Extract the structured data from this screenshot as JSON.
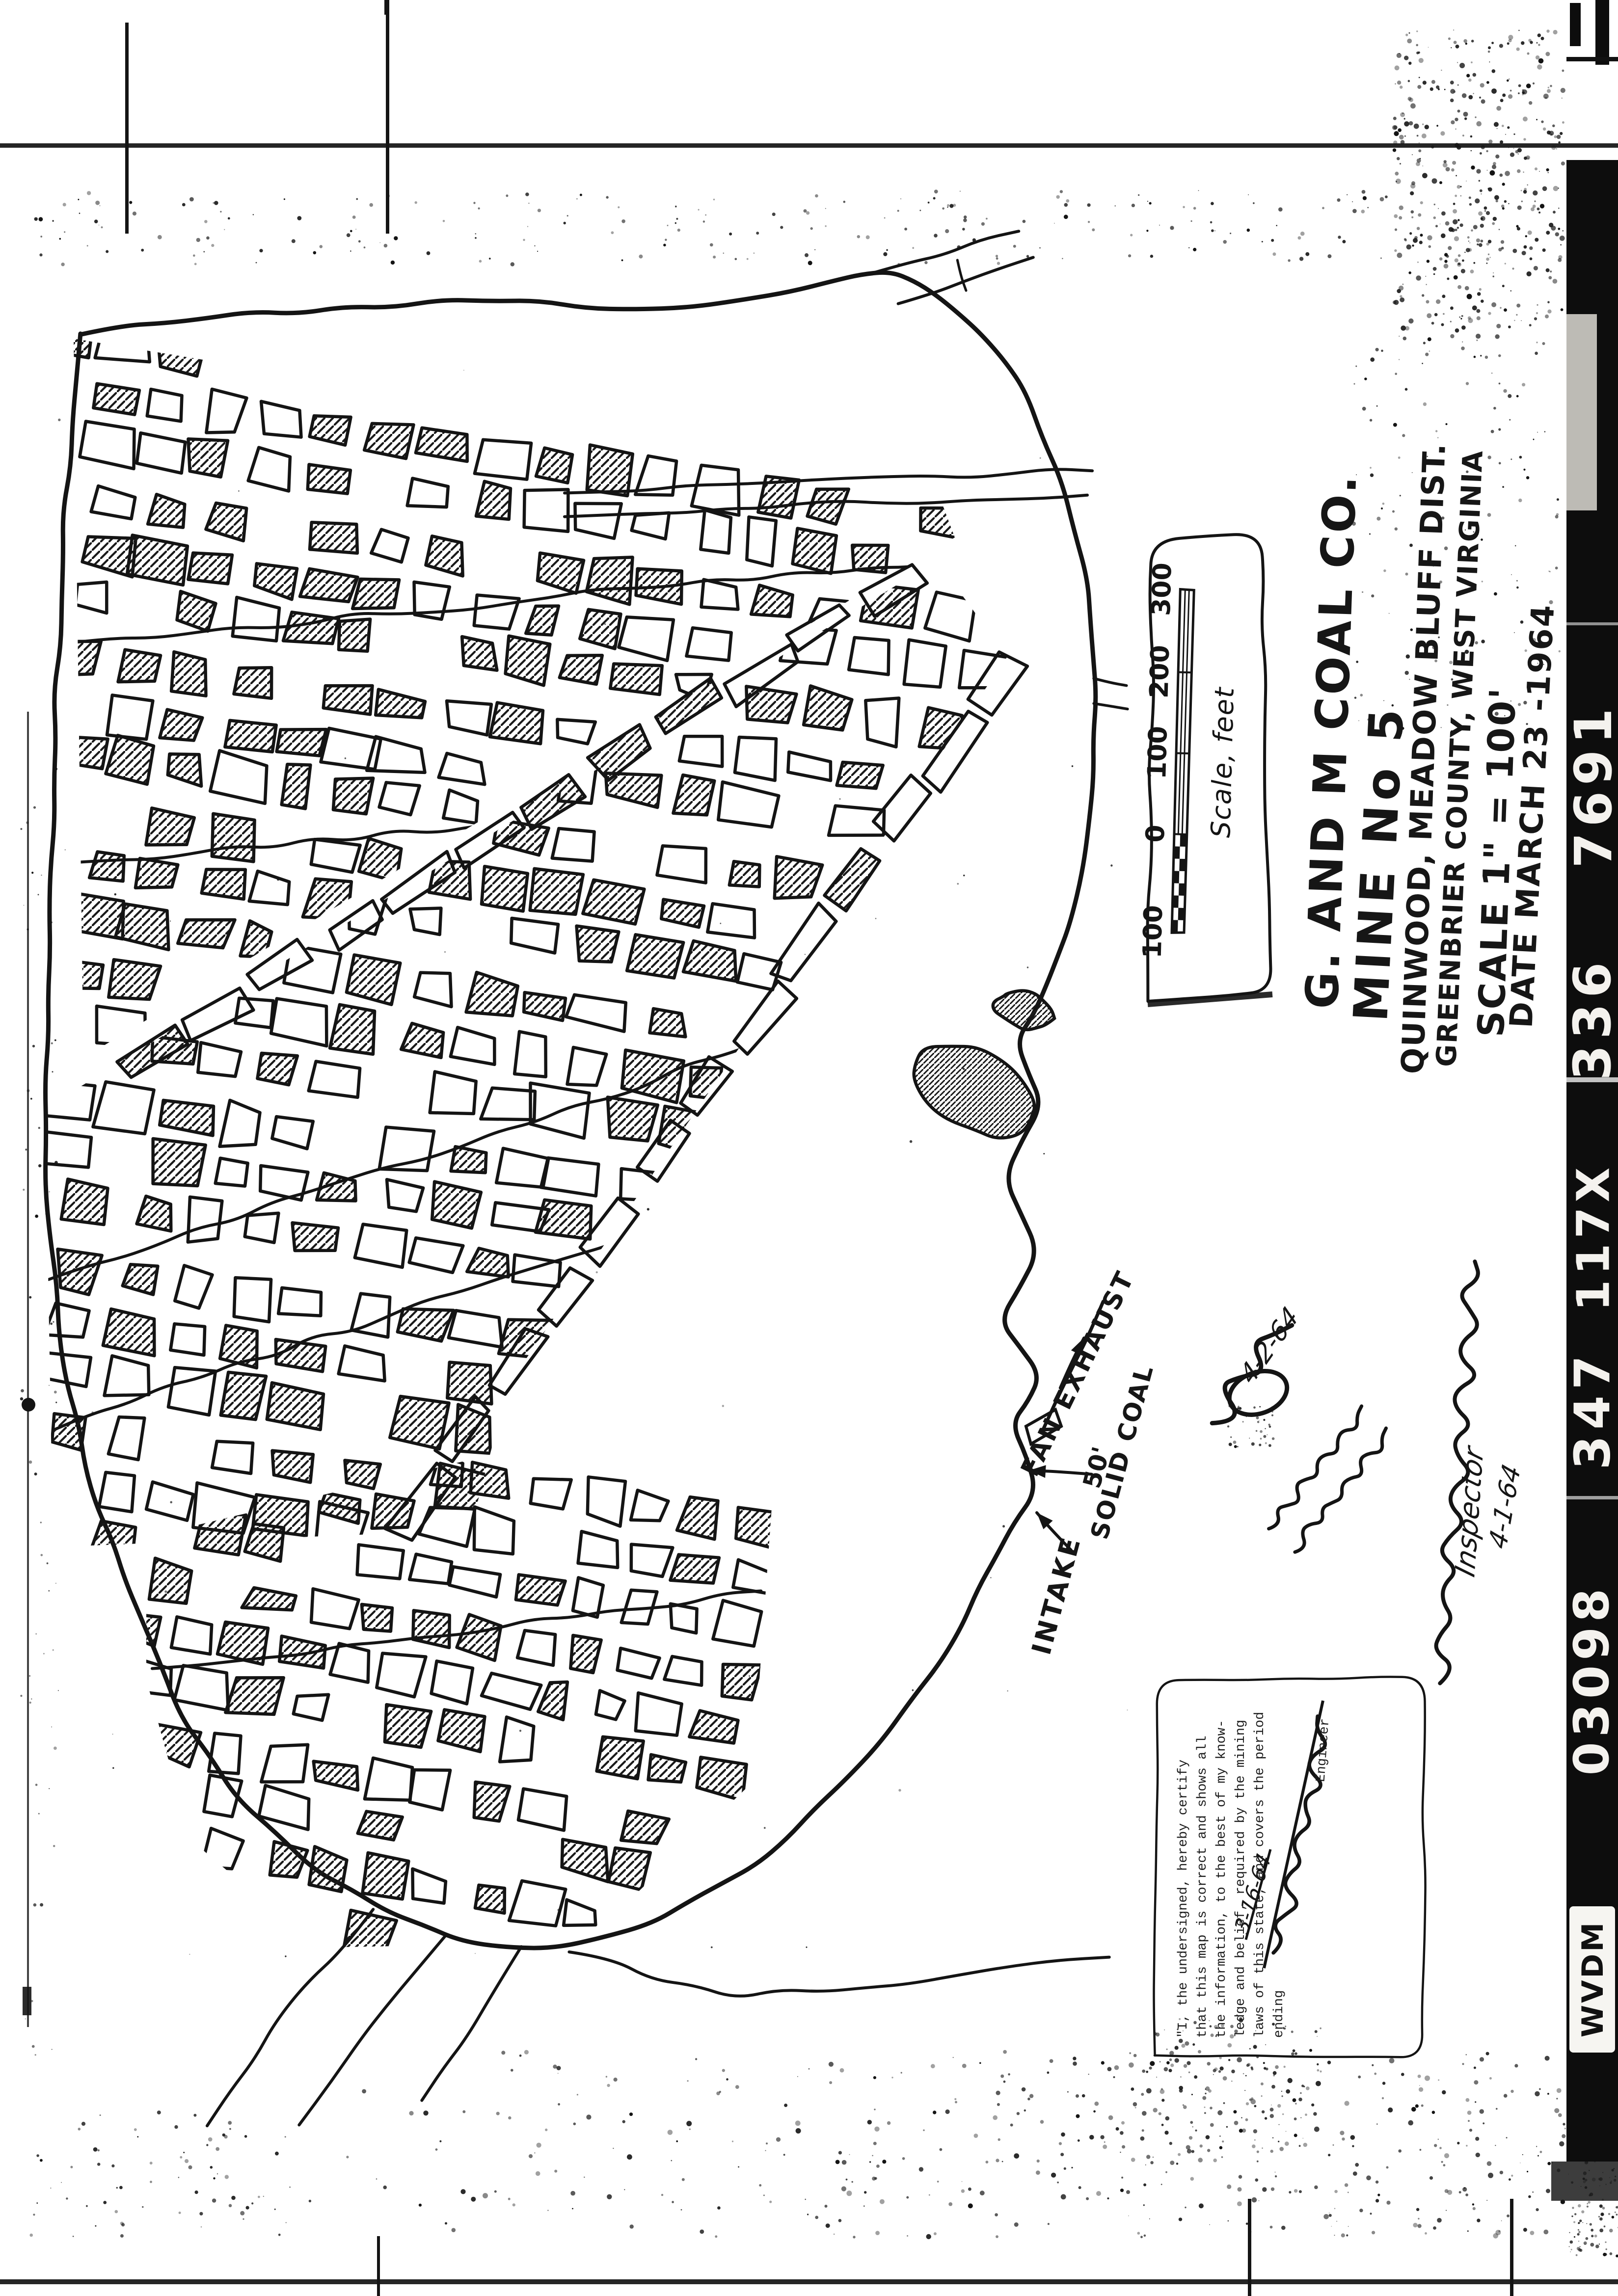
{
  "title_block": {
    "company": "G. AND M COAL CO.",
    "mine": "MINE No 5",
    "district": "QUINWOOD, MEADOW BLUFF DIST.",
    "county": "GREENBRIER COUNTY, WEST VIRGINIA",
    "scale": "SCALE 1\" = 100'",
    "date": "DATE MARCH 23 -1964"
  },
  "scale_bar": {
    "caption": "Scale, feet",
    "tick_labels": [
      "100",
      "0",
      "100",
      "200",
      "300"
    ]
  },
  "map_labels": {
    "intake": "INTAKE",
    "fan_exhaust": "FAN EXHAUST",
    "solid_coal_line1": "50'",
    "solid_coal_line2": "SOLID COAL"
  },
  "certification": {
    "lines": [
      "\"I, the undersigned, hereby certify",
      "that this map is correct and shows all",
      "the information, to the best of my know-",
      "ledge and belief, required by the mining",
      "laws of this state, and covers the period",
      "ending"
    ],
    "period_ending_date": "3-16-64",
    "engineer_label": "Engineer"
  },
  "handwritten": {
    "inspector_title": "Inspector",
    "inspector_date": "4-1-64",
    "margin_date": "4-2-64"
  },
  "film_edge": {
    "segments": [
      "7691",
      "336",
      "117X",
      "347",
      "03098"
    ],
    "agency_code": "WVDM"
  },
  "ink_color": "#141414",
  "paper_color": "#ffffff"
}
